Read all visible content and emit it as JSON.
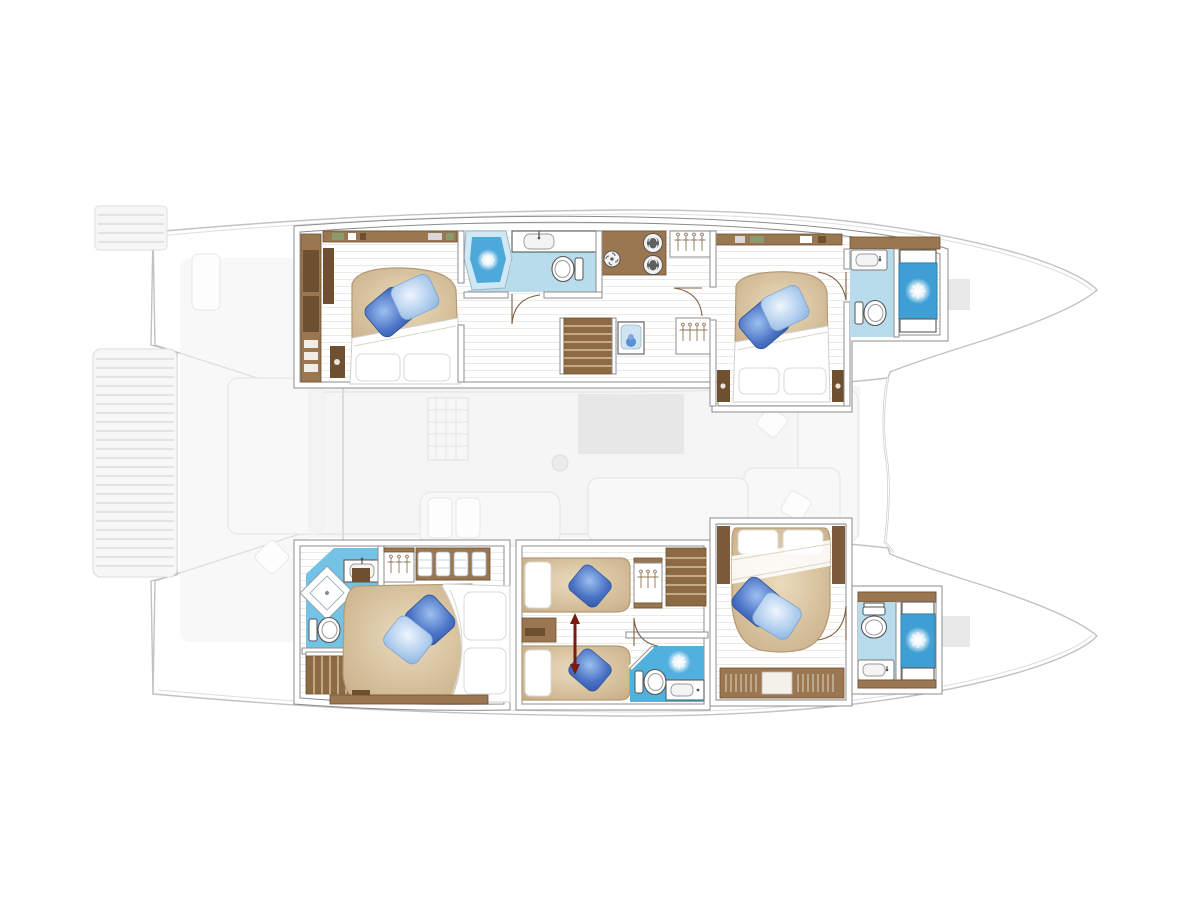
{
  "diagram": {
    "type": "floor-plan",
    "subject": "Catamaran yacht layout plan - lower deck cabin configuration, bow facing right",
    "description": "Top-down architectural plan of a sailing catamaran. The two hulls contain five en-suite cabins rendered in full colour; the main-deck saloon, cockpit, aft swim platform and foredeck are shown as a faded grey background.",
    "orientation": {
      "bow": "right",
      "stern": "left"
    },
    "hulls": [
      {
        "name": "port hull (top)",
        "spaces": [
          {
            "name": "aft double cabin",
            "features": [
              "island double bed",
              "dark and light blue deco pillows",
              "white duvet and pillows",
              "wardrobe column",
              "overhead shelf",
              "nightstand"
            ]
          },
          {
            "name": "aft bathroom",
            "features": [
              "corner shower with glass",
              "washbasin counter",
              "toilet"
            ]
          },
          {
            "name": "companionway",
            "features": [
              "staircase to saloon",
              "stacked washer-dryer",
              "appliance",
              "hanging locker",
              "vanity unit",
              "second hanging locker"
            ]
          },
          {
            "name": "forward double cabin",
            "features": [
              "island double bed",
              "dark and light blue deco pillows",
              "overhead shelf",
              "two nightstands"
            ]
          },
          {
            "name": "forward bathroom",
            "features": [
              "shower cubicle with benches",
              "washbasin",
              "toilet"
            ]
          }
        ]
      },
      {
        "name": "starboard hull (bottom)",
        "spaces": [
          {
            "name": "aft owner double cabin",
            "features": [
              "island double bed",
              "dark and light blue deco pillows",
              "corner bathroom with rotated shower tray, washbasin and toilet",
              "hanging locker",
              "linen shelves",
              "private staircase",
              "book shelf"
            ]
          },
          {
            "name": "twin cabin",
            "features": [
              "two single beds",
              "convertible-bed red double arrow",
              "white and blue pillows",
              "hanging locker",
              "nightstand"
            ]
          },
          {
            "name": "mid bathroom",
            "features": [
              "shower",
              "washbasin counter",
              "toilet"
            ]
          },
          {
            "name": "companionway",
            "features": [
              "staircase to saloon"
            ]
          },
          {
            "name": "forward double cabin",
            "features": [
              "island double bed",
              "dark and light blue deco pillows",
              "white pillows at head",
              "book shelf"
            ]
          },
          {
            "name": "forward bathroom",
            "features": [
              "shower cubicle with benches",
              "washbasin",
              "toilet"
            ]
          }
        ]
      }
    ],
    "ghost_elements": [
      "central aft swim platform with teak slats",
      "port transom steps",
      "cockpit bench and scatter cushion",
      "saloon with L-shaped sofa, low table, galley hatch and mast foot",
      "sliding-door line between cockpit and saloon",
      "bridge-deck forward edge between the bows",
      "bow deck lockers"
    ],
    "counts": {
      "cabins": 5,
      "bathrooms": 5,
      "double_berths": 4,
      "single_berths": 2,
      "staircases": 3
    },
    "icons": [
      "washer-icon",
      "fan-icon",
      "hanger-icon",
      "shower-sparkle-icon",
      "toilet-icon",
      "sink-icon",
      "stairs-icon",
      "convertible-arrow-icon",
      "linen-icon"
    ]
  },
  "colors": {
    "background": "#ffffff",
    "ghost-line": "#c2c2c2",
    "ghost-fill": "#f4f4f4",
    "wall-line": "#8c8c8c",
    "wood-cabinet": "#9b7751",
    "wood-dark": "#6e4f2f",
    "wood-step": "#8c6a44",
    "floor-edge": "#c6a67d",
    "floor-light": "#ecdaba",
    "bed-base": "#c4a981",
    "bed-light": "#eadbbc",
    "duvet": "#ffffff",
    "pillow-dark": "#4a72c4",
    "pillow-light": "#a9c9ec",
    "bath-floor-light": "#b9dcec",
    "bath-floor-medium": "#74c3e6",
    "bath-floor-bright": "#52b0de",
    "shower-blue": "#4da9da",
    "shower-deep": "#3f9fd4",
    "fixture-line": "#5a5a5a",
    "arrow-red": "#7a1b10"
  }
}
